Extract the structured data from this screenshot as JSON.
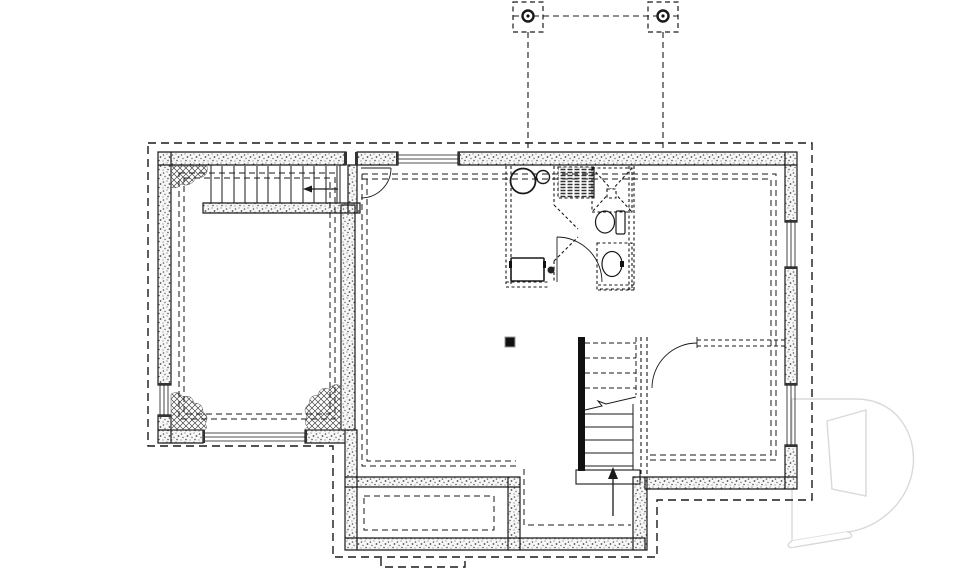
{
  "colors": {
    "background": "#ffffff",
    "line": "#1a1a1a",
    "wall_dot": "#555555",
    "hatch": "#444444",
    "jamb": "#333333",
    "post": "#111111",
    "watermark": "#d9d9d9"
  },
  "watermark": {
    "logo_letter": "D"
  },
  "plan": {
    "type": "basement-foundation-floor-plan",
    "symbols": [
      "perimeter-footing-dashed-outline",
      "concrete-foundation-walls",
      "basement-window-top",
      "basement-window-left",
      "basement-window-right-upper",
      "basement-window-right-lower",
      "garage-door-opening",
      "unexcavated-corner-hatch-top-left",
      "unexcavated-corner-hatch-bottom-left",
      "unexcavated-corner-hatch-bottom-right",
      "upper-staircase",
      "staircase-direction-arrow",
      "basement-entry-door",
      "future-bathroom-partitions",
      "water-heater",
      "expansion-tank",
      "vent-grid-pad",
      "shower",
      "toilet",
      "vanity-sink",
      "washer",
      "floor-drain",
      "central-staircase",
      "up-arrow",
      "future-room-door",
      "steel-post",
      "cold-room-inner-outline",
      "porch-step-footing",
      "deck-post-footing-left",
      "deck-post-footing-right",
      "deck-outline",
      "watermark-d-logo"
    ]
  }
}
